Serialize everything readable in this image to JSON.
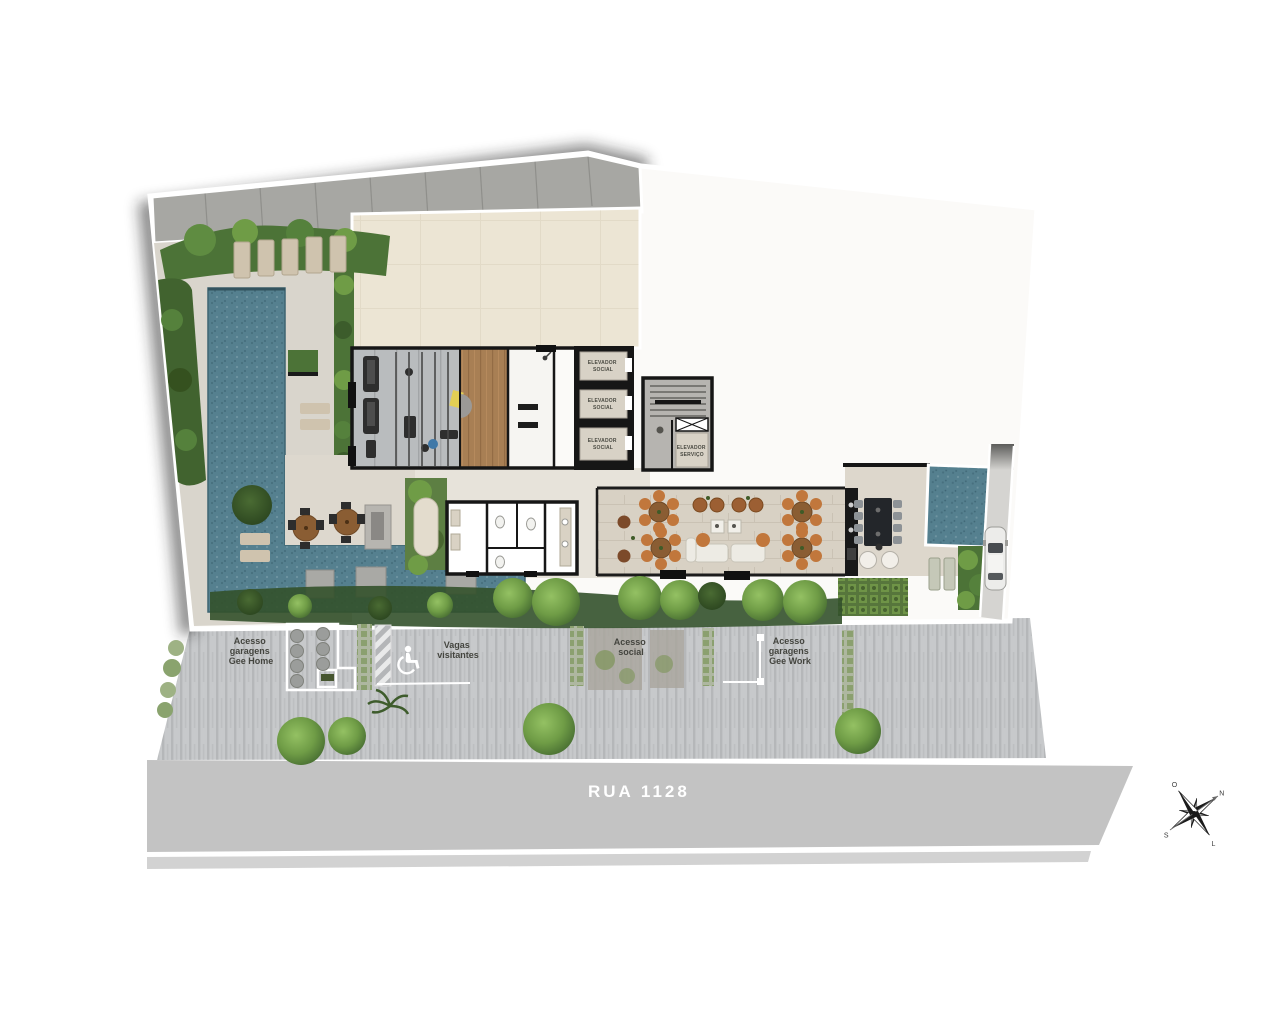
{
  "street": {
    "name": "RUA  1128"
  },
  "sidewalk_labels": {
    "acesso_garagens_home": {
      "l1": "Acesso",
      "l2": "garagens",
      "l3": "Gee Home"
    },
    "vagas_visitantes": {
      "l1": "Vagas",
      "l2": "visitantes"
    },
    "acesso_social": {
      "l1": "Acesso",
      "l2": "social"
    },
    "acesso_garagens_work": {
      "l1": "Acesso",
      "l2": "garagens",
      "l3": "Gee Work"
    }
  },
  "building_labels": {
    "elevador_social": {
      "l1": "ELEVADOR",
      "l2": "SOCIAL"
    },
    "elevador_servico": {
      "l1": "ELEVADOR",
      "l2": "SERVIÇO"
    }
  },
  "compass": {
    "north": "N",
    "south": "S",
    "east": "L",
    "west": "O"
  },
  "icons": {
    "accessibility": "wheelchair-icon",
    "compass": "compass-rose-icon"
  },
  "colors": {
    "pool_water": "#55808f",
    "hedge_green": "#4c7337",
    "tree_green": "#6f9c46",
    "building_cream": "#ece5d4",
    "gym_floor": "#b9bcbe",
    "wood_floor": "#a87f54",
    "travertine": "#d8d1c4",
    "street_gray": "#c3c3c3",
    "sidewalk_gray": "#c7c9cb",
    "wall_black": "#1a1a1a",
    "chair_orange": "#c1773c"
  }
}
